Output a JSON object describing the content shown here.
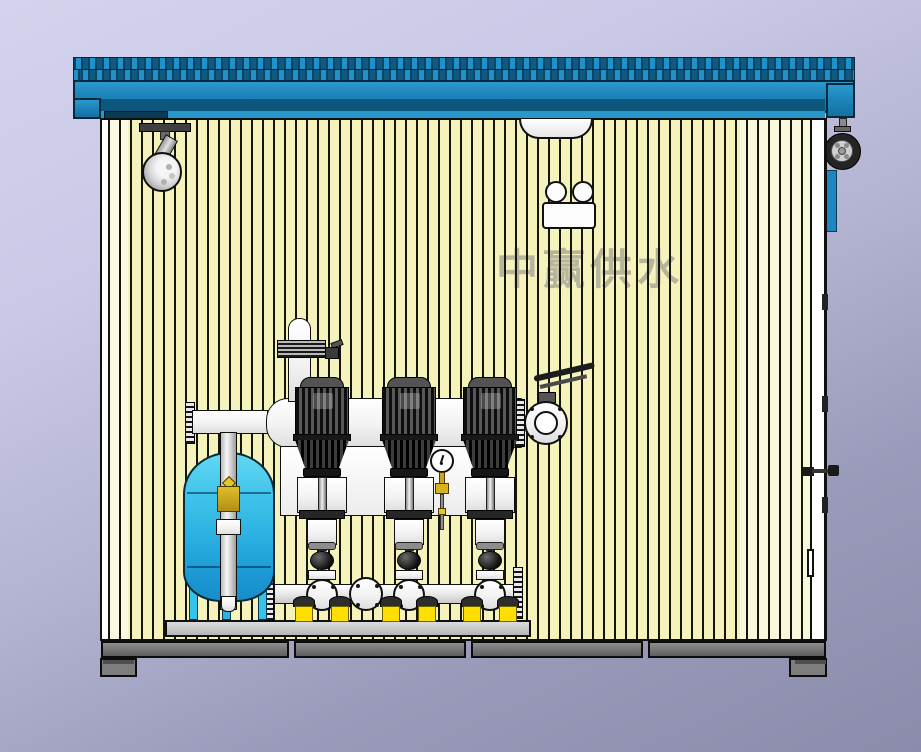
{
  "scene": {
    "type": "cad-render",
    "description": "Side section view of a containerized booster water-supply pump station",
    "watermark": "中赢供水"
  },
  "palette": {
    "background_top": "#d4d3ee",
    "background_bottom": "#8b8cab",
    "roof_blue": "#1d85bc",
    "roof_shadow": "#0d567e",
    "wall_panel_yellow": "#f6f2bc",
    "tank_blue_light": "#62d8f2",
    "tank_blue_dark": "#178dc9",
    "tank_leg_cyan": "#35c4e8",
    "motor_gray": "#2e2e2e",
    "pipe_white": "#fcfcfc",
    "skid_gray": "#cccccc",
    "frame_gray": "#6e6e6e",
    "pad_yellow": "#ffdf00",
    "brass_yellow": "#d8b31e"
  },
  "components": [
    "corrugated-roof",
    "roof-fascia",
    "wall-panels",
    "ceiling-dome-light",
    "indicator-lamp-box",
    "spotlight",
    "exterior-fan-wheel",
    "side-blue-panel",
    "door-edge",
    "door-handle",
    "air-release-valve",
    "discharge-header",
    "suction-manifold",
    "pump-1",
    "pump-2",
    "pump-3",
    "butterfly-valve",
    "pressure-gauge",
    "diaphragm-tank",
    "tank-riser-pipe",
    "brass-valve",
    "blind-flange",
    "skid-plate",
    "base-frame",
    "foot-left",
    "foot-right"
  ]
}
